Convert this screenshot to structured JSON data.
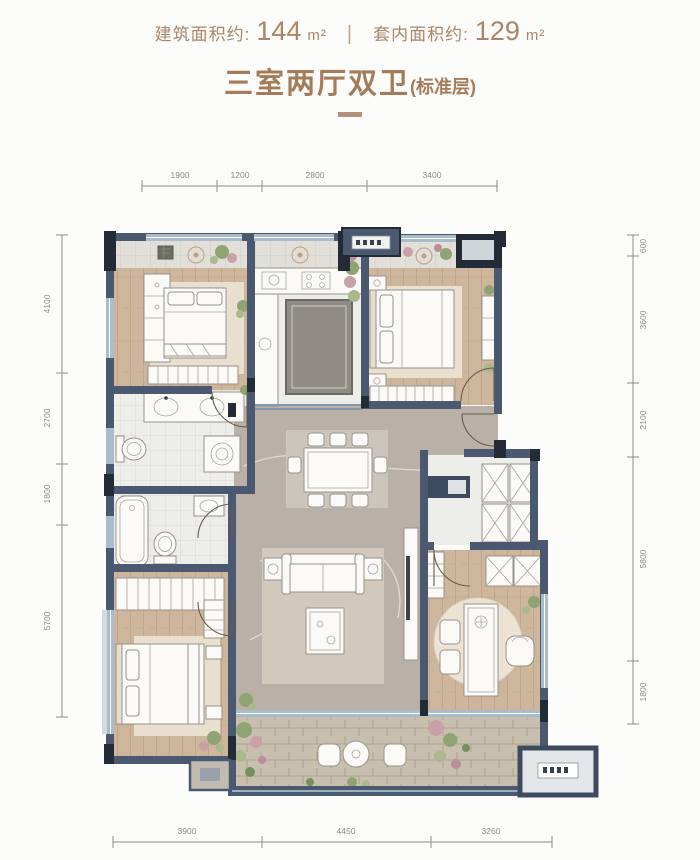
{
  "header": {
    "building_area_label": "建筑面积约:",
    "building_area_value": "144",
    "building_area_unit": "m²",
    "divider": "|",
    "inner_area_label": "套内面积约:",
    "inner_area_value": "129",
    "inner_area_unit": "m²",
    "title": "三室两厅双卫",
    "title_suffix": "(标准层)"
  },
  "dimensions": {
    "top": [
      "1900",
      "1200",
      "2800",
      "3400"
    ],
    "bottom": [
      "3900",
      "4450",
      "3260"
    ],
    "left": [
      "4100",
      "2700",
      "1800",
      "5700"
    ],
    "right": [
      "600",
      "3600",
      "2100",
      "5800",
      "1800"
    ]
  },
  "colors": {
    "accent": "#ab8565",
    "accentLight": "#c2a185",
    "wall": "#4a5970",
    "wallDark": "#232b37",
    "wood": "#cdb69c",
    "tile": "#edeeea",
    "tileGray": "#e2dfd8",
    "marble": "#b9b1a7",
    "dim": "#8e8c8a",
    "window": "#a9bccb",
    "greenery": "#8fa472",
    "paving": "#c8bfae"
  }
}
